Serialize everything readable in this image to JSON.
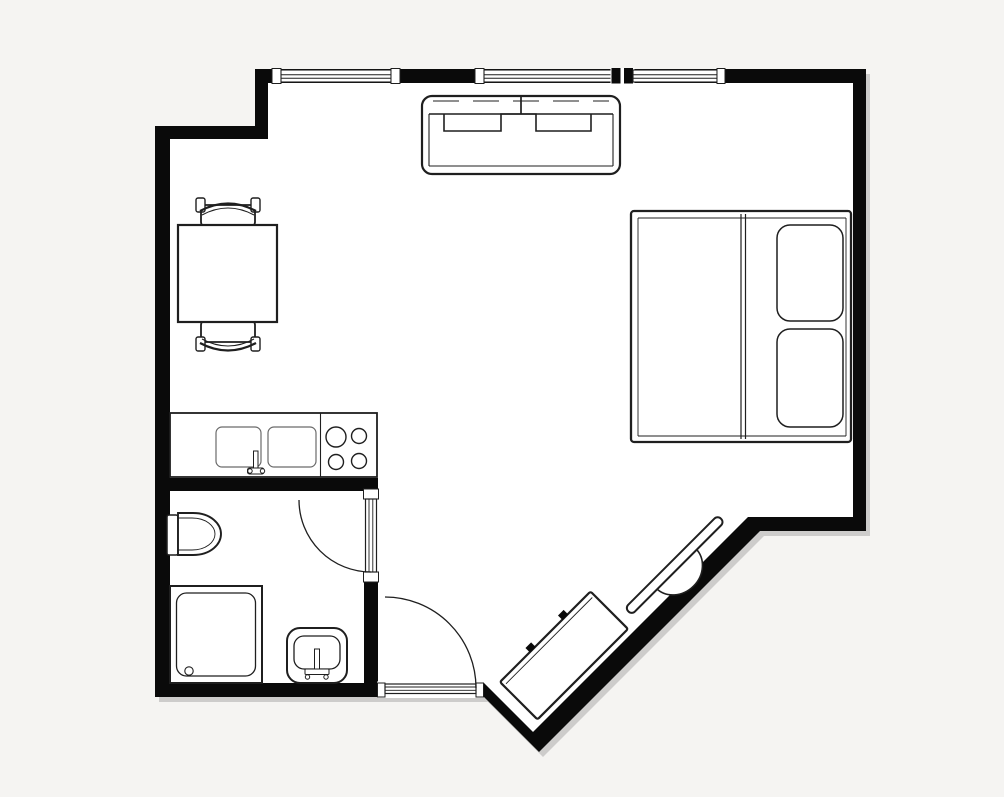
{
  "title": "Studio apartment floor plan",
  "canvas": {
    "width": 1004,
    "height": 797
  },
  "colors": {
    "background": "#f5f4f2",
    "floor": "#ffffff",
    "wall": "#0a0a0a",
    "line": "#1f1f1f",
    "line_light": "#6a6a6a",
    "shadow": "rgba(0,0,0,0.16)"
  },
  "rooms": [
    {
      "id": "main-room",
      "label": "main living and sleeping room"
    },
    {
      "id": "bathroom",
      "label": "bathroom"
    }
  ],
  "walls": {
    "outer_outline": [
      [
        255,
        69
      ],
      [
        866,
        69
      ],
      [
        866,
        531
      ],
      [
        760,
        531
      ],
      [
        539,
        752
      ],
      [
        484,
        697
      ],
      [
        155,
        697
      ],
      [
        155,
        126
      ],
      [
        255,
        126
      ]
    ],
    "inner_outline": [
      [
        268,
        83
      ],
      [
        853,
        83
      ],
      [
        853,
        517
      ],
      [
        748,
        517
      ],
      [
        533,
        732
      ],
      [
        484,
        683
      ],
      [
        170,
        683
      ],
      [
        170,
        139
      ],
      [
        268,
        139
      ]
    ],
    "interior": [
      {
        "id": "bathroom-north-wall",
        "x": 170,
        "y": 478,
        "width": 207,
        "height": 13
      },
      {
        "id": "bathroom-east-wall-upper",
        "x": 364,
        "y": 478,
        "width": 14,
        "height": 13
      },
      {
        "id": "bathroom-east-wall-lower",
        "x": 364,
        "y": 581,
        "width": 14,
        "height": 102
      }
    ]
  },
  "openings": {
    "windows": [
      {
        "id": "window-1",
        "x": 281,
        "width": 110
      },
      {
        "id": "window-2",
        "x": 484,
        "width": 127
      },
      {
        "id": "window-3",
        "x": 633,
        "width": 84
      }
    ],
    "doors": [
      {
        "id": "entry-door",
        "wall": "south",
        "x": 385,
        "width": 91,
        "swing": "inward-up"
      },
      {
        "id": "bathroom-door",
        "wall": "bathroom-east",
        "y": 499,
        "height": 73,
        "swing": "into-bathroom"
      }
    ]
  },
  "furniture": [
    {
      "id": "sofa",
      "label": "two-seat sofa",
      "x": 422,
      "y": 96,
      "width": 198,
      "height": 78
    },
    {
      "id": "dining-table",
      "label": "dining table",
      "x": 178,
      "y": 225,
      "width": 99,
      "height": 97
    },
    {
      "id": "chair-north",
      "label": "chair",
      "x": 196,
      "y": 197,
      "width": 64,
      "height": 30
    },
    {
      "id": "chair-south",
      "label": "chair",
      "x": 196,
      "y": 320,
      "width": 64,
      "height": 37
    },
    {
      "id": "bed",
      "label": "double bed with two pillows",
      "x": 631,
      "y": 211,
      "width": 220,
      "height": 231
    },
    {
      "id": "kitchen-counter",
      "label": "kitchen counter with double sink and 4-burner hob",
      "x": 170,
      "y": 413,
      "width": 207,
      "height": 64
    },
    {
      "id": "toilet",
      "label": "toilet",
      "x": 167,
      "y": 513,
      "width": 54,
      "height": 42
    },
    {
      "id": "shower",
      "label": "shower tray",
      "x": 170,
      "y": 586,
      "width": 92,
      "height": 97
    },
    {
      "id": "washbasin",
      "label": "washbasin",
      "x": 287,
      "y": 628,
      "width": 60,
      "height": 55
    },
    {
      "id": "tv",
      "label": "flat TV on stand against diagonal wall",
      "x": 625,
      "y": 608,
      "length": 131,
      "depth": 10,
      "rotation": -45
    },
    {
      "id": "tv-cabinet",
      "label": "sideboard with two knobs",
      "x": 500,
      "y": 682,
      "length": 128,
      "depth": 53,
      "rotation": -45
    }
  ]
}
